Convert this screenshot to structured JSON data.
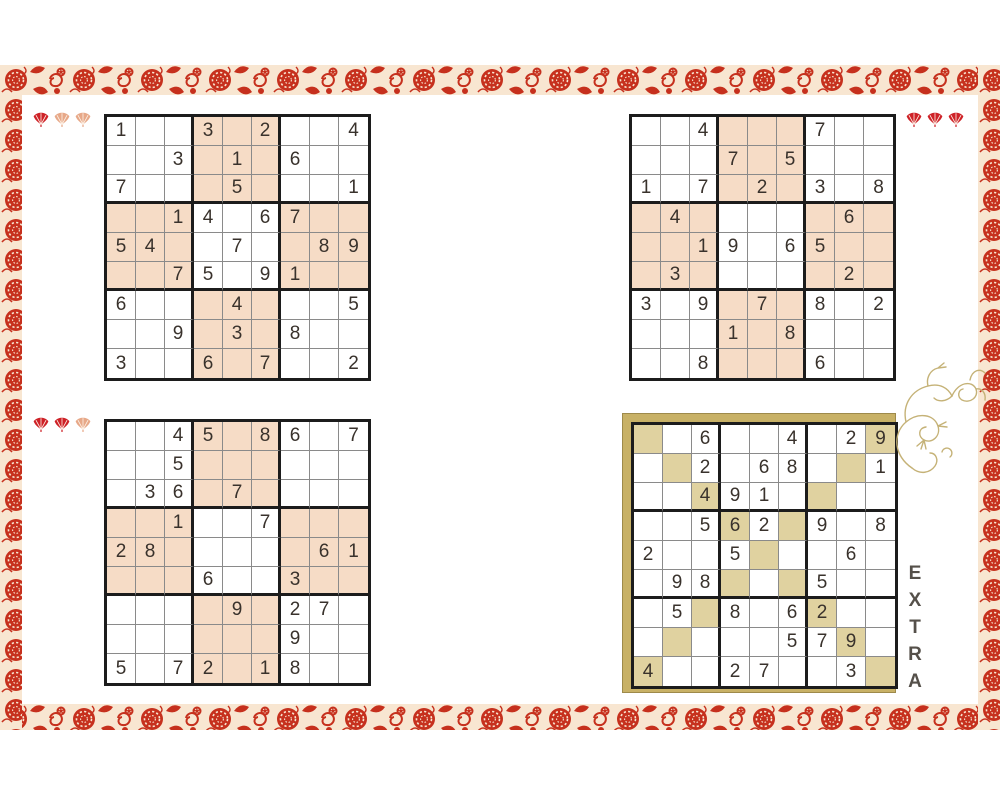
{
  "colors": {
    "border_red": "#c6301d",
    "border_cream": "#f8e6d1",
    "fan_filled": "#ce2127",
    "fan_empty": "#e7a888",
    "peach_cell": "#f6dcc6",
    "gold_cell": "#e0d2a0",
    "gold_frame": "#c8b166",
    "grid_line_thin": "#8a8a8a",
    "grid_line_thick": "#1c1c1c",
    "digit": "#39322c",
    "dragon_gold": "#c5b277"
  },
  "difficulty_fans": [
    {
      "position": "top_left",
      "filled": 1,
      "total": 3
    },
    {
      "position": "top_right",
      "filled": 3,
      "total": 3
    },
    {
      "position": "bottom_left",
      "filled": 2,
      "total": 3
    }
  ],
  "puzzles": [
    {
      "name": "puzzle-top-left",
      "variant": "checkerboard",
      "cells": [
        [
          "1",
          "",
          "",
          "3",
          "",
          "2",
          "",
          "",
          "4"
        ],
        [
          "",
          "",
          "3",
          "",
          "1",
          "",
          "6",
          "",
          ""
        ],
        [
          "7",
          "",
          "",
          "",
          "5",
          "",
          "",
          "",
          "1"
        ],
        [
          "",
          "",
          "1",
          "4",
          "",
          "6",
          "7",
          "",
          ""
        ],
        [
          "5",
          "4",
          "",
          "",
          "7",
          "",
          "",
          "8",
          "9"
        ],
        [
          "",
          "",
          "7",
          "5",
          "",
          "9",
          "1",
          "",
          ""
        ],
        [
          "6",
          "",
          "",
          "",
          "4",
          "",
          "",
          "",
          "5"
        ],
        [
          "",
          "",
          "9",
          "",
          "3",
          "",
          "8",
          "",
          ""
        ],
        [
          "3",
          "",
          "",
          "6",
          "",
          "7",
          "",
          "",
          "2"
        ]
      ]
    },
    {
      "name": "puzzle-top-right",
      "variant": "checkerboard",
      "cells": [
        [
          "",
          "",
          "4",
          "",
          "",
          "",
          "7",
          "",
          ""
        ],
        [
          "",
          "",
          "",
          "7",
          "",
          "5",
          "",
          "",
          ""
        ],
        [
          "1",
          "",
          "7",
          "",
          "2",
          "",
          "3",
          "",
          "8"
        ],
        [
          "",
          "4",
          "",
          "",
          "",
          "",
          "",
          "6",
          ""
        ],
        [
          "",
          "",
          "1",
          "9",
          "",
          "6",
          "5",
          "",
          ""
        ],
        [
          "",
          "3",
          "",
          "",
          "",
          "",
          "",
          "2",
          ""
        ],
        [
          "3",
          "",
          "9",
          "",
          "7",
          "",
          "8",
          "",
          "2"
        ],
        [
          "",
          "",
          "",
          "1",
          "",
          "8",
          "",
          "",
          ""
        ],
        [
          "",
          "",
          "8",
          "",
          "",
          "",
          "6",
          "",
          ""
        ]
      ]
    },
    {
      "name": "puzzle-bottom-left",
      "variant": "checkerboard",
      "cells": [
        [
          "",
          "",
          "4",
          "5",
          "",
          "8",
          "6",
          "",
          "7"
        ],
        [
          "",
          "",
          "5",
          "",
          "",
          "",
          "",
          "",
          ""
        ],
        [
          "",
          "3",
          "6",
          "",
          "7",
          "",
          "",
          "",
          ""
        ],
        [
          "",
          "",
          "1",
          "",
          "",
          "7",
          "",
          "",
          ""
        ],
        [
          "2",
          "8",
          "",
          "",
          "",
          "",
          "",
          "6",
          "1"
        ],
        [
          "",
          "",
          "",
          "6",
          "",
          "",
          "3",
          "",
          ""
        ],
        [
          "",
          "",
          "",
          "",
          "9",
          "",
          "2",
          "7",
          ""
        ],
        [
          "",
          "",
          "",
          "",
          "",
          "",
          "9",
          "",
          ""
        ],
        [
          "5",
          "",
          "7",
          "2",
          "",
          "1",
          "8",
          "",
          ""
        ]
      ]
    },
    {
      "name": "puzzle-extra",
      "variant": "diagonals",
      "cells": [
        [
          "",
          "",
          "6",
          "",
          "",
          "4",
          "",
          "2",
          "9"
        ],
        [
          "",
          "",
          "2",
          "",
          "6",
          "8",
          "",
          "",
          "1"
        ],
        [
          "",
          "",
          "4",
          "9",
          "1",
          "",
          "",
          "",
          ""
        ],
        [
          "",
          "",
          "5",
          "6",
          "2",
          "",
          "9",
          "",
          "8"
        ],
        [
          "2",
          "",
          "",
          "5",
          "",
          "",
          "",
          "6",
          ""
        ],
        [
          "",
          "9",
          "8",
          "",
          "",
          "",
          "5",
          "",
          ""
        ],
        [
          "",
          "5",
          "",
          "8",
          "",
          "6",
          "2",
          "",
          ""
        ],
        [
          "",
          "",
          "",
          "",
          "",
          "5",
          "7",
          "9",
          ""
        ],
        [
          "4",
          "",
          "",
          "2",
          "7",
          "",
          "",
          "3",
          ""
        ]
      ]
    }
  ],
  "extra": {
    "label": "EXTRA",
    "letters": [
      "E",
      "X",
      "T",
      "R",
      "A"
    ]
  }
}
